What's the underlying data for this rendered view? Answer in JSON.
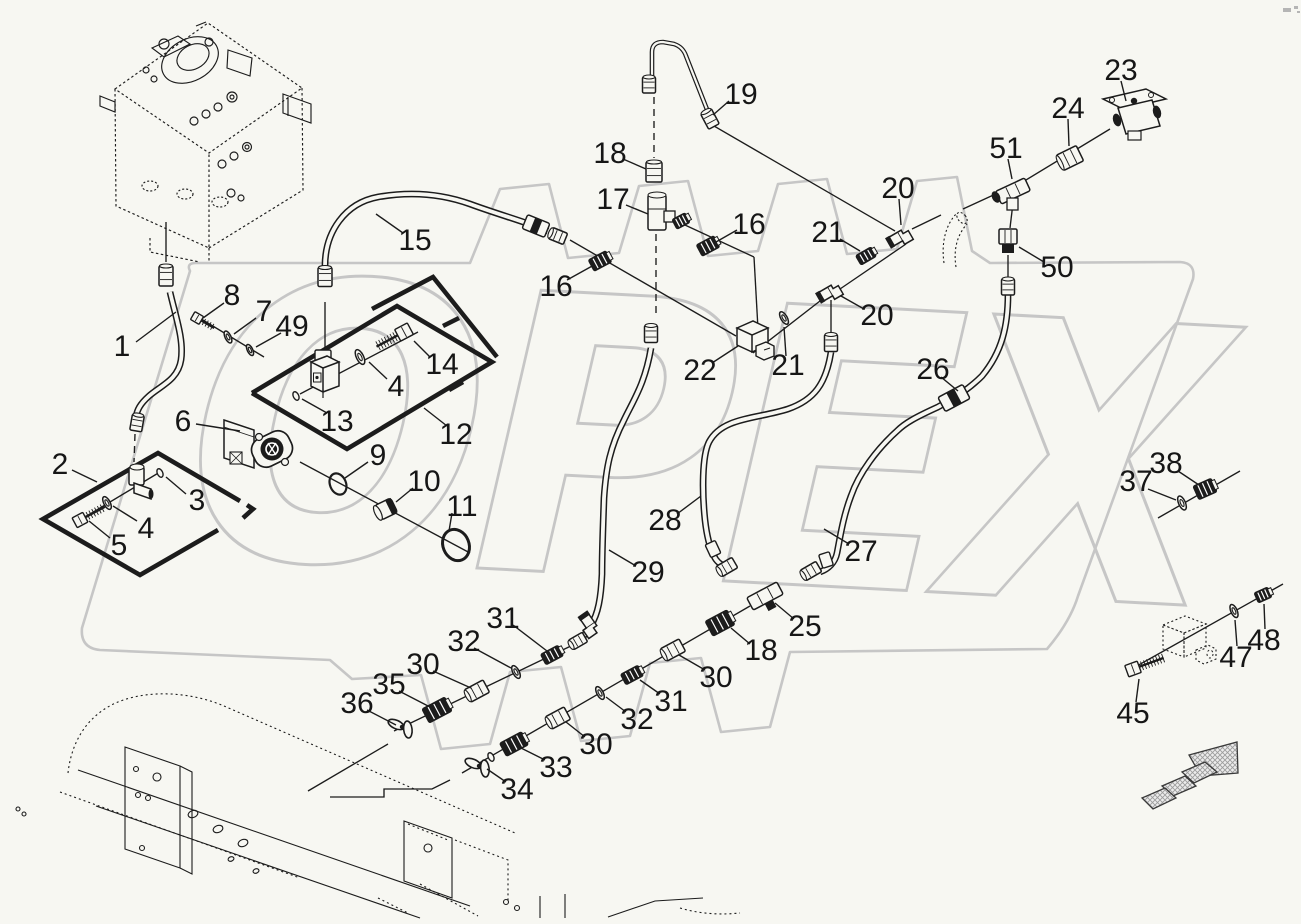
{
  "canvas": {
    "width": 1301,
    "height": 924,
    "background": "#f7f7f2",
    "ink": "#1c1c1c"
  },
  "watermark": {
    "text": "OPEX",
    "color": "#c6c6c6",
    "stamp_path": "M190 271 Q186 263 196 263 L470 263 L500 189 L549 184 L568 258 L619 253 L639 186 L688 181 L708 256 L758 251 L778 184 L827 179 L847 254 L897 249 L917 181 L957 177 L972 251 L990 263 L1180 262 Q1196 263 1193 279 L1078 596 Q1070 622 1047 649 L790 652 L770 727 L721 732 L701 658 L650 663 L630 736 L581 741 L561 667 L510 672 L490 744 L441 749 L421 675 L352 679 L330 660 L100 650 Q80 648 82 628 Z"
  },
  "logo_marks": [
    [
      1283,
      8,
      8,
      4
    ],
    [
      1294,
      6,
      4,
      3
    ],
    [
      1297,
      11,
      3,
      2
    ]
  ],
  "callouts": [
    [
      "1",
      122,
      346,
      136,
      342,
      176,
      312
    ],
    [
      "8",
      232,
      295,
      224,
      303,
      203,
      318
    ],
    [
      "7",
      264,
      311,
      256,
      318,
      234,
      334
    ],
    [
      "49",
      292,
      326,
      281,
      333,
      256,
      347
    ],
    [
      "15",
      415,
      240,
      403,
      233,
      376,
      214
    ],
    [
      "14",
      442,
      364,
      430,
      357,
      414,
      341
    ],
    [
      "4",
      396,
      386,
      387,
      379,
      369,
      362
    ],
    [
      "13",
      337,
      421,
      327,
      413,
      302,
      399
    ],
    [
      "12",
      456,
      434,
      447,
      426,
      424,
      408
    ],
    [
      "6",
      183,
      421,
      196,
      424,
      240,
      431
    ],
    [
      "2",
      60,
      464,
      72,
      470,
      97,
      482
    ],
    [
      "3",
      197,
      500,
      186,
      494,
      166,
      477
    ],
    [
      "4",
      146,
      528,
      137,
      521,
      113,
      506
    ],
    [
      "5",
      119,
      545,
      110,
      538,
      89,
      521
    ],
    [
      "9",
      378,
      455,
      368,
      462,
      345,
      478
    ],
    [
      "10",
      424,
      481,
      413,
      488,
      396,
      502
    ],
    [
      "11",
      462,
      506,
      452,
      513,
      449,
      531
    ],
    [
      "16",
      556,
      286,
      567,
      280,
      594,
      265
    ],
    [
      "17",
      613,
      199,
      626,
      205,
      648,
      214
    ],
    [
      "18",
      610,
      153,
      623,
      159,
      646,
      169
    ],
    [
      "19",
      741,
      94,
      729,
      101,
      713,
      115
    ],
    [
      "16",
      749,
      224,
      737,
      230,
      716,
      242
    ],
    [
      "20",
      898,
      188,
      899,
      199,
      901,
      225
    ],
    [
      "21",
      828,
      232,
      840,
      239,
      860,
      251
    ],
    [
      "20",
      877,
      315,
      864,
      309,
      841,
      296
    ],
    [
      "21",
      788,
      365,
      786,
      356,
      784,
      327
    ],
    [
      "22",
      700,
      370,
      712,
      363,
      738,
      346
    ],
    [
      "23",
      1121,
      70,
      1121,
      81,
      1126,
      101
    ],
    [
      "24",
      1068,
      108,
      1068,
      119,
      1069,
      146
    ],
    [
      "51",
      1006,
      148,
      1008,
      159,
      1012,
      179
    ],
    [
      "50",
      1057,
      267,
      1044,
      262,
      1019,
      247
    ],
    [
      "26",
      933,
      369,
      941,
      377,
      958,
      391
    ],
    [
      "28",
      665,
      520,
      677,
      514,
      701,
      496
    ],
    [
      "27",
      861,
      551,
      849,
      544,
      824,
      529
    ],
    [
      "29",
      648,
      572,
      636,
      566,
      609,
      550
    ],
    [
      "25",
      805,
      626,
      794,
      619,
      775,
      603
    ],
    [
      "18",
      761,
      650,
      750,
      644,
      731,
      628
    ],
    [
      "30",
      716,
      677,
      705,
      670,
      679,
      655
    ],
    [
      "31",
      671,
      701,
      660,
      694,
      640,
      680
    ],
    [
      "32",
      637,
      719,
      626,
      712,
      606,
      697
    ],
    [
      "30",
      596,
      744,
      585,
      737,
      566,
      722
    ],
    [
      "33",
      556,
      767,
      545,
      760,
      521,
      748
    ],
    [
      "34",
      517,
      789,
      506,
      782,
      487,
      769
    ],
    [
      "31",
      503,
      618,
      513,
      625,
      547,
      651
    ],
    [
      "32",
      464,
      641,
      474,
      648,
      511,
      668
    ],
    [
      "30",
      423,
      664,
      433,
      671,
      471,
      688
    ],
    [
      "35",
      389,
      684,
      399,
      691,
      430,
      707
    ],
    [
      "36",
      357,
      703,
      367,
      710,
      396,
      725
    ],
    [
      "37",
      1136,
      481,
      1148,
      489,
      1176,
      500
    ],
    [
      "38",
      1166,
      463,
      1178,
      471,
      1199,
      485
    ],
    [
      "45",
      1133,
      713,
      1136,
      702,
      1139,
      679
    ],
    [
      "47",
      1236,
      657,
      1237,
      646,
      1235,
      620
    ],
    [
      "48",
      1264,
      640,
      1265,
      629,
      1264,
      604
    ]
  ],
  "panels": {
    "solid": [
      [
        252,
        393,
        397,
        306,
        492,
        362,
        347,
        449,
        252,
        393
      ],
      [
        372,
        309,
        433,
        277,
        497,
        357
      ],
      [
        240,
        501,
        158,
        453,
        43,
        519,
        140,
        575,
        218,
        530
      ],
      [
        247,
        505,
        253,
        509,
        243,
        518
      ]
    ],
    "dashes": [
      [
        443,
        326,
        459,
        318
      ],
      [
        449,
        390,
        463,
        382
      ]
    ]
  },
  "hoses": [
    "M170 292 C176 318 184 340 181 360 C178 380 160 386 149 396 C140 404 137 410 136 417",
    "M325 266 C325 232 345 203 378 197 C412 191 442 194 470 204 C497 214 526 222 548 231",
    "M1008 294 C1008 326 1002 352 982 376 C966 392 950 400 938 407 C916 417 905 423 897 431 C877 449 859 473 851 496 C843 517 840 538 837 553 C835 563 828 569 820 572",
    "M831 352 C826 384 814 400 788 409 C757 419 722 417 709 442 C702 456 702 492 705 520 C707 538 710 548 714 556 C716 561 721 565 726 567",
    "M651 348 C645 384 633 401 624 420 C610 447 606 468 604 498 C603 528 602 552 602 574 C601 598 598 614 591 625 C588 630 584 636 580 640"
  ],
  "tubes": [
    "M652 80 L652 52 Q652 42 663 42 L674 44 Q683 47 686 56 L708 112"
  ],
  "lines": [
    [
      570,
      240,
      736,
      336
    ],
    [
      672,
      219,
      754,
      257
    ],
    [
      754,
      257,
      758,
      329
    ],
    [
      753,
      353,
      829,
      294
    ],
    [
      906,
      244,
      840,
      289
    ],
    [
      912,
      229,
      941,
      215
    ],
    [
      963,
      209,
      1000,
      192
    ],
    [
      1016,
      186,
      1110,
      129
    ],
    [
      714,
      126,
      895,
      231
    ],
    [
      1158,
      518,
      1240,
      471
    ],
    [
      1128,
      671,
      1283,
      584
    ],
    [
      193,
      314,
      264,
      357
    ],
    [
      300,
      462,
      470,
      553
    ],
    [
      575,
      644,
      394,
      731
    ],
    [
      750,
      606,
      462,
      773
    ],
    [
      388,
      744,
      308,
      791
    ],
    [
      300,
      394,
      418,
      332
    ],
    [
      80,
      520,
      160,
      472
    ],
    [
      831,
      300,
      831,
      336
    ],
    [
      166,
      222,
      166,
      262
    ],
    [
      325,
      302,
      325,
      350
    ],
    [
      1013,
      203,
      1010,
      228
    ],
    [
      1008,
      255,
      1008,
      280
    ]
  ],
  "polylines": [
    [
      450,
      780,
      432,
      789,
      384,
      789,
      384,
      797,
      330,
      797
    ]
  ],
  "dashlines": [
    [
      654,
      97,
      654,
      158
    ],
    [
      656,
      234,
      656,
      316
    ],
    [
      135,
      434,
      134,
      462
    ]
  ],
  "parts": [
    {
      "t": "nut",
      "x": 166,
      "y": 276,
      "a": 90,
      "w": 20,
      "h": 14
    },
    {
      "t": "nut",
      "x": 137,
      "y": 423,
      "a": 100,
      "w": 16,
      "h": 12
    },
    {
      "t": "elbow3",
      "x": 137,
      "y": 480
    },
    {
      "t": "washer",
      "x": 107,
      "y": 503,
      "a": -28,
      "r": 7
    },
    {
      "t": "bolt",
      "x": 80,
      "y": 520,
      "a": -28,
      "len": 22,
      "hr": 5.5
    },
    {
      "t": "ring",
      "x": 160,
      "y": 473,
      "r": 4.5
    },
    {
      "t": "pump6",
      "x": 256,
      "y": 444
    },
    {
      "t": "ring",
      "x": 296,
      "y": 396,
      "r": 4.5
    },
    {
      "t": "valve13",
      "x": 323,
      "y": 372
    },
    {
      "t": "washer",
      "x": 360,
      "y": 357,
      "a": -26,
      "r": 8
    },
    {
      "t": "bolt",
      "x": 404,
      "y": 332,
      "a": 152,
      "len": 24,
      "hr": 6.5
    },
    {
      "t": "bolt",
      "x": 197,
      "y": 318,
      "a": 30,
      "len": 15,
      "hr": 4.5
    },
    {
      "t": "washer",
      "x": 228,
      "y": 337,
      "a": -26,
      "r": 6.5
    },
    {
      "t": "washer",
      "x": 250,
      "y": 350,
      "a": -26,
      "r": 6
    },
    {
      "t": "oring",
      "x": 338,
      "y": 484,
      "a": -22,
      "rx": 8,
      "ry": 11,
      "sw": 2.2
    },
    {
      "t": "plug",
      "x": 386,
      "y": 509,
      "a": -26
    },
    {
      "t": "oring",
      "x": 456,
      "y": 545,
      "a": -22,
      "rx": 13,
      "ry": 16,
      "sw": 3
    },
    {
      "t": "nut",
      "x": 325,
      "y": 277,
      "a": 90,
      "w": 19,
      "h": 14
    },
    {
      "t": "union",
      "x": 536,
      "y": 226,
      "a": 22,
      "w": 24,
      "h": 15
    },
    {
      "t": "nut",
      "x": 558,
      "y": 236,
      "a": 22,
      "w": 16,
      "h": 12
    },
    {
      "t": "dnut",
      "x": 600,
      "y": 261,
      "a": -28,
      "w": 20,
      "h": 13
    },
    {
      "t": "nut",
      "x": 654,
      "y": 172,
      "a": 90,
      "w": 20,
      "h": 16
    },
    {
      "t": "tee17",
      "x": 657,
      "y": 213
    },
    {
      "t": "dnut",
      "x": 708,
      "y": 246,
      "a": -28,
      "w": 20,
      "h": 13
    },
    {
      "t": "nut",
      "x": 649,
      "y": 85,
      "a": 90,
      "w": 16,
      "h": 13
    },
    {
      "t": "nut",
      "x": 710,
      "y": 119,
      "a": 62,
      "w": 17,
      "h": 12
    },
    {
      "t": "elbow",
      "x": 901,
      "y": 236,
      "a": -30
    },
    {
      "t": "dnut",
      "x": 866,
      "y": 256,
      "a": -30,
      "w": 18,
      "h": 11
    },
    {
      "t": "elbow",
      "x": 831,
      "y": 291,
      "a": -30
    },
    {
      "t": "washer",
      "x": 784,
      "y": 318,
      "a": -30,
      "r": 7
    },
    {
      "t": "block22",
      "x": 750,
      "y": 338
    },
    {
      "t": "nut",
      "x": 831,
      "y": 343,
      "a": 90,
      "w": 17,
      "h": 13
    },
    {
      "t": "nut",
      "x": 651,
      "y": 334,
      "a": 90,
      "w": 17,
      "h": 13
    },
    {
      "t": "ghostelbow",
      "x": 952,
      "y": 235
    },
    {
      "t": "tee51",
      "x": 1013,
      "y": 191
    },
    {
      "t": "nut",
      "x": 1070,
      "y": 158,
      "a": -26,
      "w": 22,
      "h": 17
    },
    {
      "t": "valve23",
      "x": 1132,
      "y": 113
    },
    {
      "t": "fit50",
      "x": 1008,
      "y": 238
    },
    {
      "t": "nut",
      "x": 1008,
      "y": 287,
      "a": 90,
      "w": 16,
      "h": 13
    },
    {
      "t": "union",
      "x": 954,
      "y": 398,
      "a": -28,
      "w": 28,
      "h": 16
    },
    {
      "t": "sleeve",
      "x": 713,
      "y": 549,
      "a": 65
    },
    {
      "t": "sleeve",
      "x": 826,
      "y": 560,
      "a": 72
    },
    {
      "t": "nut",
      "x": 727,
      "y": 567,
      "a": -30,
      "w": 18,
      "h": 12
    },
    {
      "t": "nut",
      "x": 811,
      "y": 571,
      "a": -30,
      "w": 18,
      "h": 12
    },
    {
      "t": "teefit",
      "x": 765,
      "y": 596
    },
    {
      "t": "dnut",
      "x": 720,
      "y": 623,
      "a": -28,
      "w": 25,
      "h": 17
    },
    {
      "t": "nut",
      "x": 673,
      "y": 650,
      "a": -28,
      "w": 21,
      "h": 14
    },
    {
      "t": "dnut",
      "x": 632,
      "y": 675,
      "a": -28,
      "w": 20,
      "h": 12
    },
    {
      "t": "washer",
      "x": 600,
      "y": 693,
      "a": -28,
      "r": 7
    },
    {
      "t": "nut",
      "x": 558,
      "y": 718,
      "a": -28,
      "w": 21,
      "h": 14
    },
    {
      "t": "dnut",
      "x": 514,
      "y": 744,
      "a": -28,
      "w": 25,
      "h": 15
    },
    {
      "t": "wing",
      "x": 479,
      "y": 766,
      "a": -28
    },
    {
      "t": "ring",
      "x": 491,
      "y": 757,
      "r": 4.5
    },
    {
      "t": "elbow",
      "x": 591,
      "y": 626,
      "a": 55
    },
    {
      "t": "nut",
      "x": 578,
      "y": 641,
      "a": -30,
      "w": 16,
      "h": 11
    },
    {
      "t": "dnut",
      "x": 552,
      "y": 655,
      "a": -28,
      "w": 20,
      "h": 12
    },
    {
      "t": "washer",
      "x": 516,
      "y": 672,
      "a": -28,
      "r": 7
    },
    {
      "t": "nut",
      "x": 477,
      "y": 691,
      "a": -28,
      "w": 21,
      "h": 14
    },
    {
      "t": "dnut",
      "x": 437,
      "y": 710,
      "a": -28,
      "w": 26,
      "h": 16
    },
    {
      "t": "wing",
      "x": 402,
      "y": 727,
      "a": -28
    },
    {
      "t": "washer",
      "x": 1182,
      "y": 503,
      "a": -24,
      "r": 7.5
    },
    {
      "t": "dnut",
      "x": 1205,
      "y": 489,
      "a": -24,
      "w": 20,
      "h": 15
    },
    {
      "t": "bolt",
      "x": 1133,
      "y": 669,
      "a": -20,
      "len": 26,
      "hr": 6
    },
    {
      "t": "ghostblock",
      "x": 1185,
      "y": 637
    },
    {
      "t": "washer",
      "x": 1234,
      "y": 611,
      "a": -24,
      "r": 7
    },
    {
      "t": "dnut",
      "x": 1263,
      "y": 595,
      "a": -24,
      "w": 15,
      "h": 11
    }
  ],
  "tank": {
    "dashed": [
      "M115 89 L208 23 L302 88 L209 153 Z",
      "M115 89 L116 206 L209 248 L209 153",
      "M302 88 L303 190 L209 248",
      "M150 238 L150 252 L200 262",
      "M209 248 L209 262"
    ],
    "solid": [
      "M283 94 L311 104 L311 123 L283 113 Z",
      "M288 97 L288 116",
      "M100 96 L115 102 L115 112 L100 106 Z",
      "M152 48 L178 36 L190 44 L164 57 Z",
      "M196 26 L206 22",
      "M228 50 L252 58 L250 76 L227 68 Z"
    ],
    "pump_ellipses": [
      [
        190,
        60,
        30,
        21,
        -28
      ],
      [
        193,
        57,
        17,
        12,
        -28
      ]
    ],
    "circles": [
      [
        164,
        44,
        5
      ],
      [
        209,
        42,
        4
      ],
      [
        146,
        70,
        3
      ],
      [
        154,
        79,
        3
      ],
      [
        232,
        97,
        5
      ],
      [
        232,
        97,
        2
      ],
      [
        218,
        107,
        4
      ],
      [
        206,
        114,
        4
      ],
      [
        194,
        121,
        4
      ],
      [
        247,
        147,
        4.5
      ],
      [
        247,
        147,
        2
      ],
      [
        234,
        156,
        4
      ],
      [
        222,
        164,
        4
      ],
      [
        231,
        193,
        4
      ],
      [
        241,
        198,
        3
      ]
    ],
    "dot_ellipses": [
      [
        150,
        186,
        8,
        5
      ],
      [
        185,
        194,
        8,
        5
      ],
      [
        220,
        202,
        8,
        5
      ]
    ]
  },
  "frame": {
    "dashed": [
      "M68 773 C72 737 92 708 130 698 C160 690 196 694 224 706",
      "M224 706 L515 833",
      "M60 792 L300 878",
      "M455 840 L508 860 L508 902",
      "M420 884 L478 916",
      "M408 824 L448 840",
      "M378 898 L408 913",
      "M680 908 C700 914 720 915 740 913"
    ],
    "solid": [
      "M78 770 L470 906",
      "M96 806 L420 918",
      "M608 917 L655 901 L703 898",
      "M125 747 L180 766 L180 868 L125 849 Z",
      "M180 766 L192 772 L192 874 L180 868",
      "M404 821 L452 838 L452 898 L404 881 Z",
      "M540 896 L540 918",
      "M565 894 L565 918"
    ],
    "circles": [
      [
        136,
        769,
        2.5
      ],
      [
        138,
        795,
        2.5
      ],
      [
        148,
        798,
        2.5
      ],
      [
        157,
        777,
        4
      ],
      [
        142,
        848,
        2.5
      ],
      [
        428,
        848,
        4
      ],
      [
        18,
        809,
        2
      ],
      [
        24,
        814,
        2
      ],
      [
        506,
        902,
        2.5
      ],
      [
        517,
        908,
        2.5
      ]
    ],
    "holes": [
      [
        193,
        814,
        5,
        3.5
      ],
      [
        218,
        829,
        5,
        3.5
      ],
      [
        243,
        843,
        5,
        3.5
      ],
      [
        231,
        859,
        3,
        2.2
      ],
      [
        256,
        871,
        3,
        2.2
      ]
    ]
  },
  "arrow": {
    "head": "M1189 755 L1237 742 L1238 773 L1201 776 Z",
    "segs": [
      "M1182 772 L1205 762 L1217 772 L1194 783 Z",
      "M1162 786 L1185 776 L1196 786 L1173 796 Z",
      "M1142 798 L1165 788 L1176 798 L1153 809 Z"
    ]
  }
}
